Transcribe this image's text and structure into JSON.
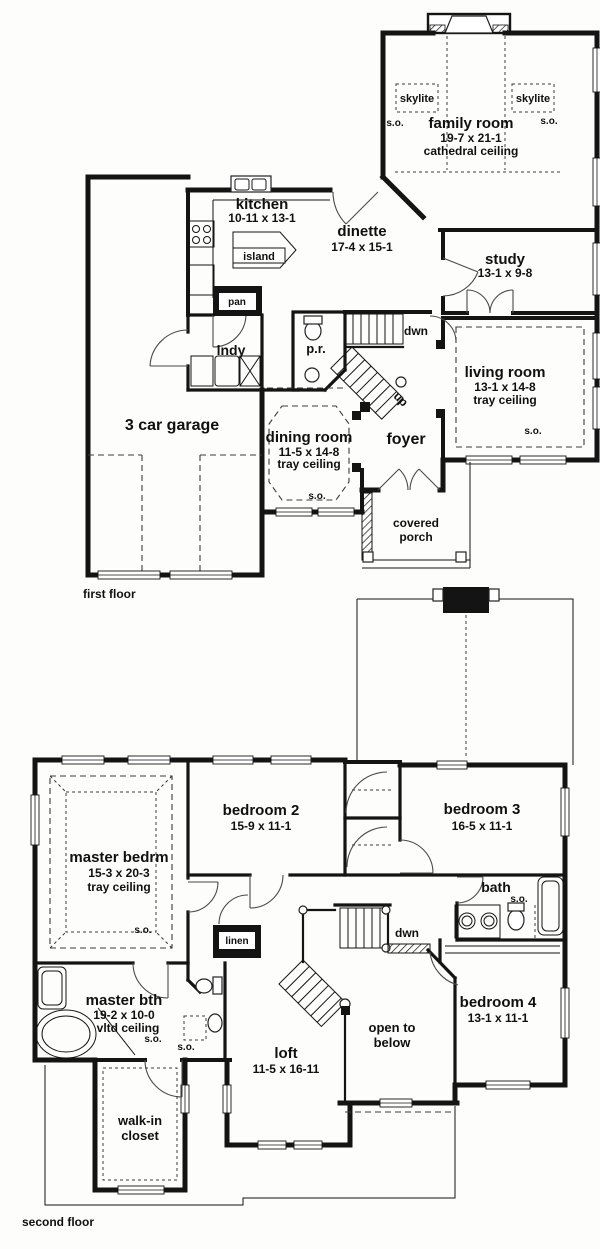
{
  "first_floor": {
    "floor_label": "first floor",
    "family_room": {
      "name": "family room",
      "dims": "19-7 x 21-1",
      "ceiling": "cathedral ceiling"
    },
    "skylite": "skylite",
    "so": "s.o.",
    "kitchen": {
      "name": "kitchen",
      "dims": "10-11 x 13-1"
    },
    "island": "island",
    "dinette": {
      "name": "dinette",
      "dims": "17-4 x 15-1"
    },
    "study": {
      "name": "study",
      "dims": "13-1 x 9-8"
    },
    "living_room": {
      "name": "living room",
      "dims": "13-1 x 14-8",
      "ceiling": "tray ceiling"
    },
    "pantry": "pan",
    "laundry": "lndy",
    "powder_room": "p.r.",
    "stairs": {
      "down": "dwn",
      "up": "up"
    },
    "garage": {
      "name": "3 car garage"
    },
    "dining_room": {
      "name": "dining room",
      "dims": "11-5 x 14-8",
      "ceiling": "tray ceiling"
    },
    "foyer": "foyer",
    "porch": {
      "line1": "covered",
      "line2": "porch"
    }
  },
  "second_floor": {
    "floor_label": "second floor",
    "so": "s.o.",
    "master_bedroom": {
      "name": "master bedrm",
      "dims": "15-3 x 20-3",
      "ceiling": "tray ceiling"
    },
    "bedroom2": {
      "name": "bedroom 2",
      "dims": "15-9 x 11-1"
    },
    "bedroom3": {
      "name": "bedroom 3",
      "dims": "16-5 x 11-1"
    },
    "bedroom4": {
      "name": "bedroom 4",
      "dims": "13-1 x 11-1"
    },
    "bath": "bath",
    "linen": "linen",
    "stairs": {
      "down": "dwn"
    },
    "master_bath": {
      "name": "master bth",
      "dims": "19-2 x 10-0",
      "ceiling": "vltd ceiling"
    },
    "walkin_closet": {
      "line1": "walk-in",
      "line2": "closet"
    },
    "loft": {
      "name": "loft",
      "dims": "11-5 x 16-11"
    },
    "open_to_below": {
      "line1": "open to",
      "line2": "below"
    }
  }
}
